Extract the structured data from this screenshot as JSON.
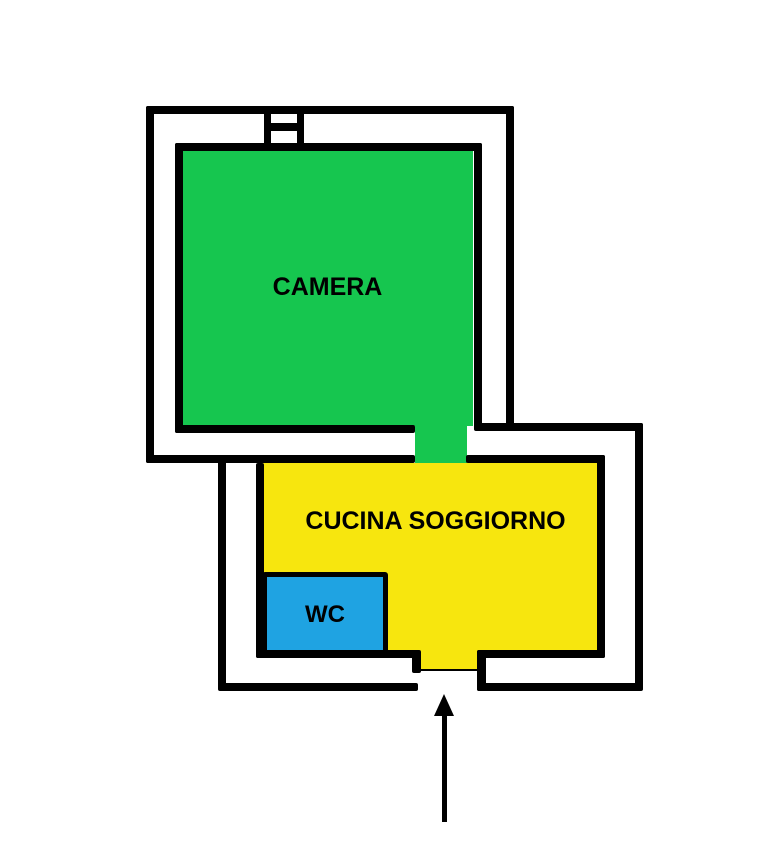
{
  "floorplan": {
    "background_color": "#ffffff",
    "wall_color": "#000000",
    "rooms": [
      {
        "id": "camera",
        "label": "CAMERA",
        "color": "#16c64f"
      },
      {
        "id": "cucina-soggiorno",
        "label": "CUCINA SOGGIORNO",
        "color": "#f7e60e"
      },
      {
        "id": "wc",
        "label": "WC",
        "color": "#1fa3e2"
      }
    ],
    "symbols": {
      "window": "window-symbol-top-wall",
      "entrance_arrow": "up-arrow-at-entrance-door"
    }
  }
}
